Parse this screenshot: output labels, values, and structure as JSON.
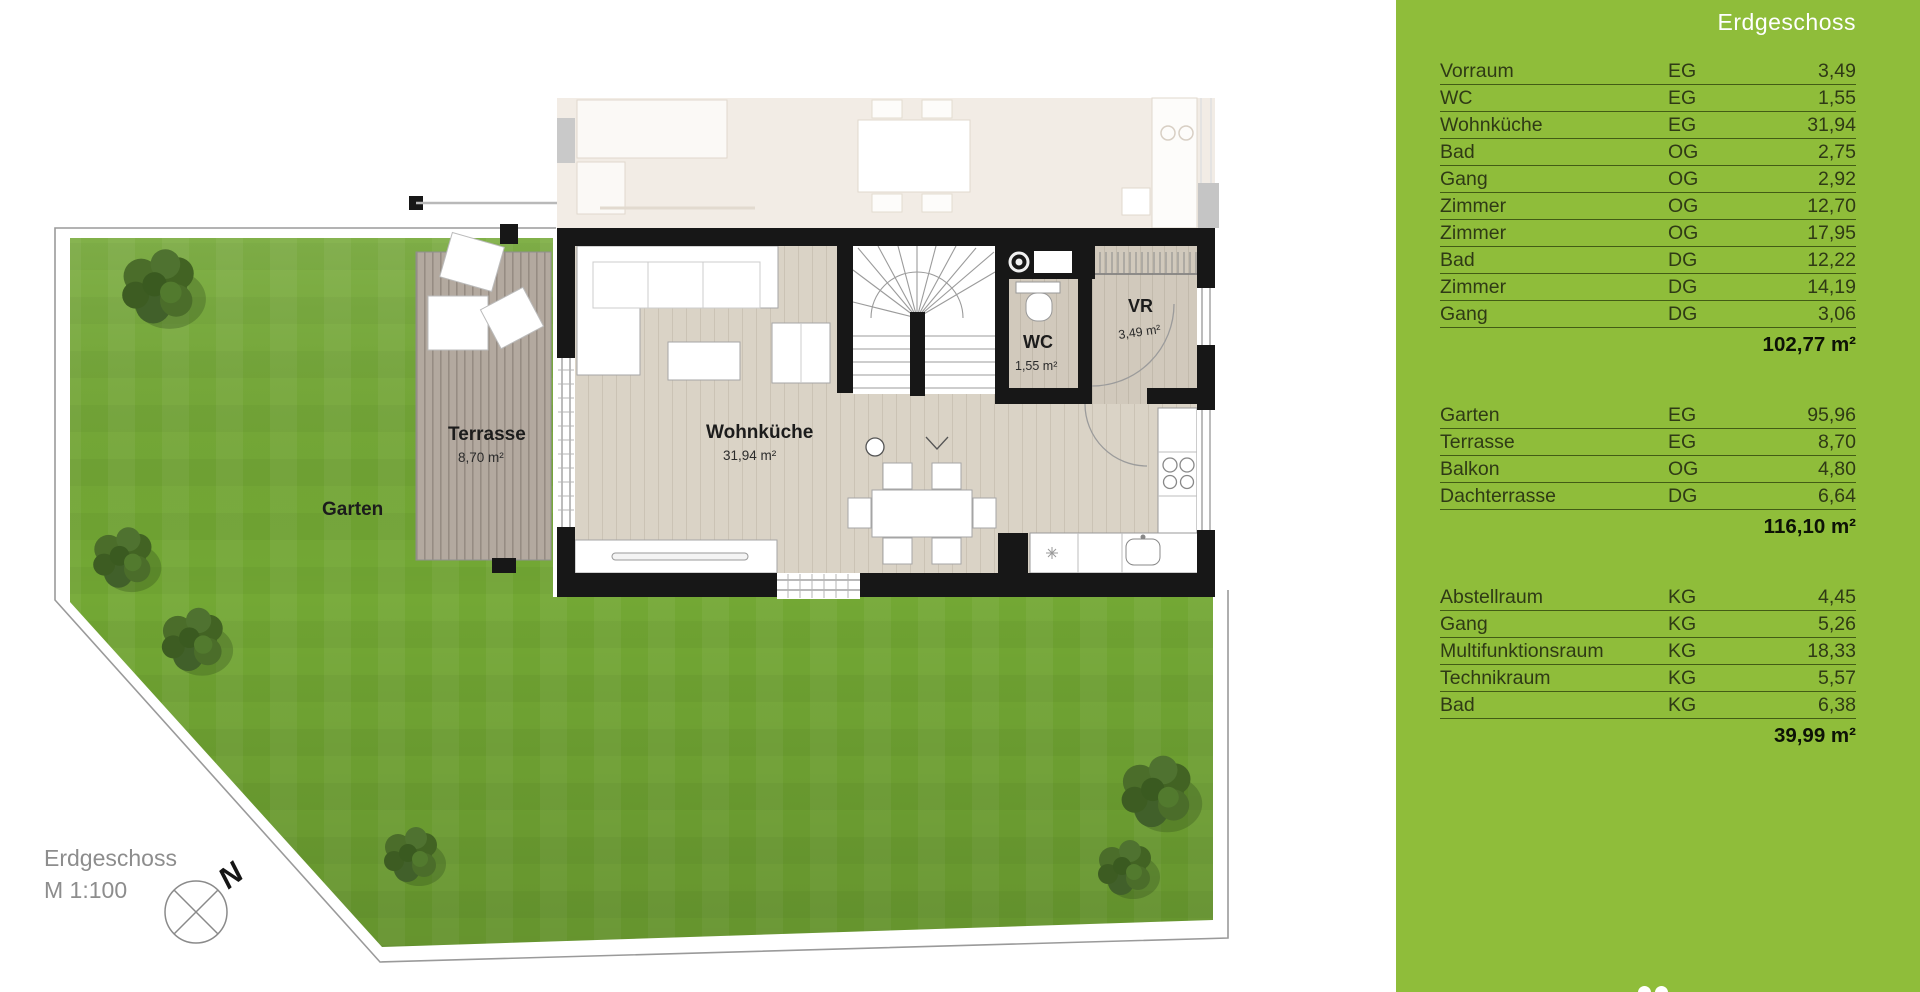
{
  "plan": {
    "floor_label": "Erdgeschoss",
    "scale_label": "M 1:100",
    "compass": {
      "north_label": "N"
    },
    "rooms": {
      "wohnkueche": {
        "name": "Wohnküche",
        "area": "31,94 m²"
      },
      "wc": {
        "name": "WC",
        "area": "1,55 m²"
      },
      "vr": {
        "name": "VR",
        "area": "3,49 m²"
      },
      "terrasse": {
        "name": "Terrasse",
        "area": "8,70 m²"
      },
      "garten": {
        "name": "Garten"
      }
    }
  },
  "sidebar": {
    "title": "Erdgeschoss",
    "colors": {
      "background": "#8fbd3a",
      "row_line": "#3c5410",
      "row_text": "#2f3a15",
      "total_text": "#0d1206",
      "title_text": "#ffffff"
    },
    "groups": [
      {
        "rows": [
          {
            "name": "Vorraum",
            "level": "EG",
            "value": "3,49"
          },
          {
            "name": "WC",
            "level": "EG",
            "value": "1,55"
          },
          {
            "name": "Wohnküche",
            "level": "EG",
            "value": "31,94"
          },
          {
            "name": "Bad",
            "level": "OG",
            "value": "2,75"
          },
          {
            "name": "Gang",
            "level": "OG",
            "value": "2,92"
          },
          {
            "name": "Zimmer",
            "level": "OG",
            "value": "12,70"
          },
          {
            "name": "Zimmer",
            "level": "OG",
            "value": "17,95"
          },
          {
            "name": "Bad",
            "level": "DG",
            "value": "12,22"
          },
          {
            "name": "Zimmer",
            "level": "DG",
            "value": "14,19"
          },
          {
            "name": "Gang",
            "level": "DG",
            "value": "3,06"
          }
        ],
        "total": "102,77 m²"
      },
      {
        "rows": [
          {
            "name": "Garten",
            "level": "EG",
            "value": "95,96"
          },
          {
            "name": "Terrasse",
            "level": "EG",
            "value": "8,70"
          },
          {
            "name": "Balkon",
            "level": "OG",
            "value": "4,80"
          },
          {
            "name": "Dachterrasse",
            "level": "DG",
            "value": "6,64"
          }
        ],
        "total": "116,10 m²"
      },
      {
        "rows": [
          {
            "name": "Abstellraum",
            "level": "KG",
            "value": "4,45"
          },
          {
            "name": "Gang",
            "level": "KG",
            "value": "5,26"
          },
          {
            "name": "Multifunktionsraum",
            "level": "KG",
            "value": "18,33"
          },
          {
            "name": "Technikraum",
            "level": "KG",
            "value": "5,57"
          },
          {
            "name": "Bad",
            "level": "KG",
            "value": "6,38"
          }
        ],
        "total": "39,99 m²"
      }
    ]
  }
}
